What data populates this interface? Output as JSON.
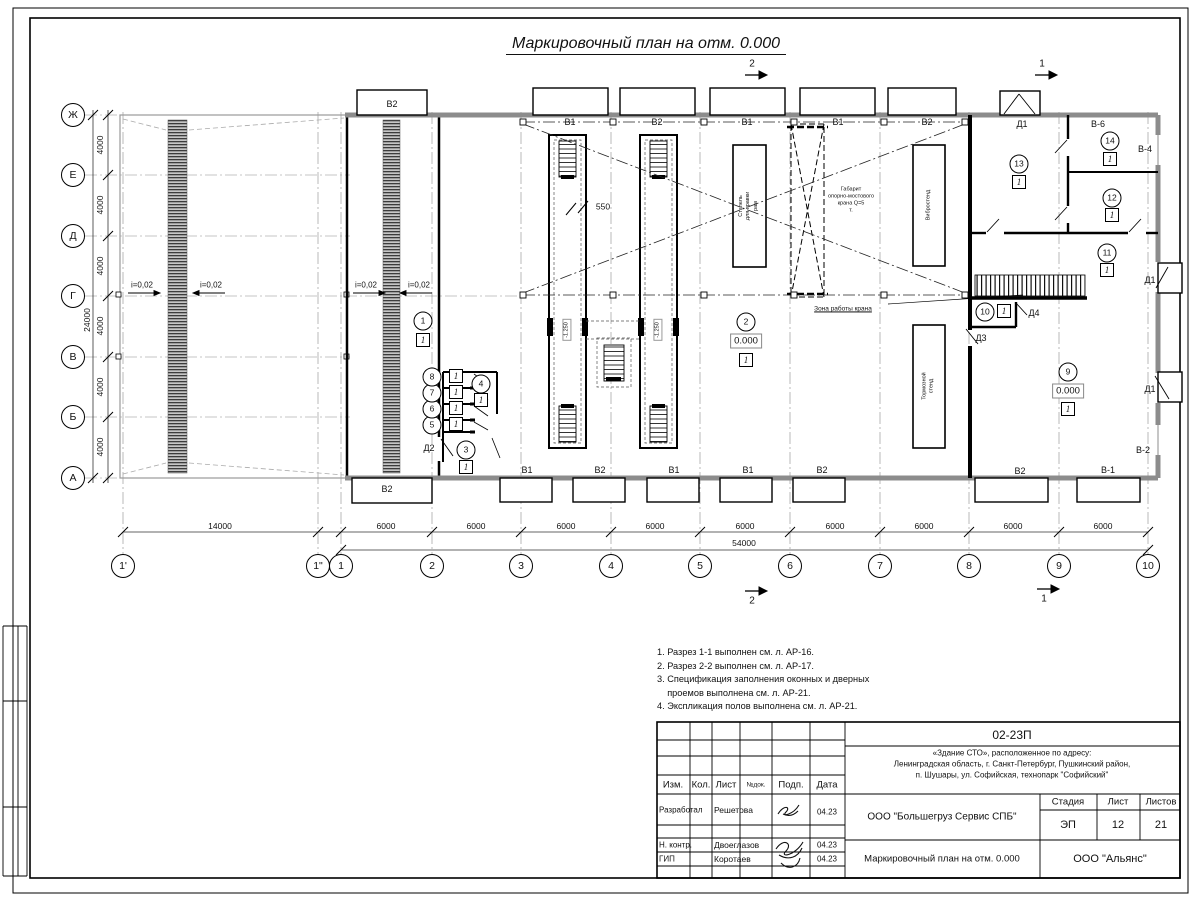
{
  "sheet_title": "Маркировочный план на отм. 0.000",
  "elevation": "0.000",
  "floor_mark": "1",
  "axes": {
    "rows": [
      {
        "l": "Ж",
        "y": 115
      },
      {
        "l": "Е",
        "y": 175
      },
      {
        "l": "Д",
        "y": 236
      },
      {
        "l": "Г",
        "y": 296
      },
      {
        "l": "В",
        "y": 357
      },
      {
        "l": "Б",
        "y": 417
      },
      {
        "l": "А",
        "y": 478
      }
    ],
    "cols": [
      {
        "l": "1'",
        "x": 123
      },
      {
        "l": "1\"",
        "x": 318
      },
      {
        "l": "1",
        "x": 341
      },
      {
        "l": "2",
        "x": 432
      },
      {
        "l": "3",
        "x": 521
      },
      {
        "l": "4",
        "x": 611
      },
      {
        "l": "5",
        "x": 700
      },
      {
        "l": "6",
        "x": 790
      },
      {
        "l": "7",
        "x": 880
      },
      {
        "l": "8",
        "x": 969
      },
      {
        "l": "9",
        "x": 1059
      },
      {
        "l": "10",
        "x": 1148
      }
    ],
    "row_dims": [
      {
        "t": "4000",
        "y": 145
      },
      {
        "t": "4000",
        "y": 205
      },
      {
        "t": "4000",
        "y": 266
      },
      {
        "t": "4000",
        "y": 326
      },
      {
        "t": "4000",
        "y": 387
      },
      {
        "t": "4000",
        "y": 447
      }
    ],
    "row_total": {
      "t": "24000",
      "y": 320
    },
    "col_dims": [
      {
        "t": "14000",
        "x": 220
      },
      {
        "t": "6000",
        "x": 386
      },
      {
        "t": "6000",
        "x": 476
      },
      {
        "t": "6000",
        "x": 566
      },
      {
        "t": "6000",
        "x": 655
      },
      {
        "t": "6000",
        "x": 745
      },
      {
        "t": "6000",
        "x": 835
      },
      {
        "t": "6000",
        "x": 924
      },
      {
        "t": "6000",
        "x": 1013
      },
      {
        "t": "6000",
        "x": 1103
      }
    ],
    "col_total": {
      "t": "54000",
      "x": 744
    }
  },
  "plan_labels": [
    {
      "t": "В2",
      "x": 392,
      "y": 105,
      "c": "win"
    },
    {
      "t": "В1",
      "x": 570,
      "y": 123,
      "c": "win"
    },
    {
      "t": "В2",
      "x": 657,
      "y": 123,
      "c": "win"
    },
    {
      "t": "В1",
      "x": 747,
      "y": 123,
      "c": "win"
    },
    {
      "t": "В1",
      "x": 838,
      "y": 123,
      "c": "win"
    },
    {
      "t": "В2",
      "x": 927,
      "y": 123,
      "c": "win"
    },
    {
      "t": "Д1",
      "x": 1022,
      "y": 125,
      "c": "door"
    },
    {
      "t": "В-6",
      "x": 1098,
      "y": 125,
      "c": "win"
    },
    {
      "t": "В-4",
      "x": 1145,
      "y": 150,
      "c": "win"
    },
    {
      "t": "Д1",
      "x": 1150,
      "y": 281,
      "c": "door"
    },
    {
      "t": "Д1",
      "x": 1150,
      "y": 390,
      "c": "door"
    },
    {
      "t": "В-2",
      "x": 1143,
      "y": 451,
      "c": "win"
    },
    {
      "t": "В2",
      "x": 387,
      "y": 490,
      "c": "win"
    },
    {
      "t": "В1",
      "x": 527,
      "y": 471,
      "c": "win"
    },
    {
      "t": "В2",
      "x": 600,
      "y": 471,
      "c": "win"
    },
    {
      "t": "В1",
      "x": 674,
      "y": 471,
      "c": "win"
    },
    {
      "t": "В1",
      "x": 748,
      "y": 471,
      "c": "win"
    },
    {
      "t": "В2",
      "x": 822,
      "y": 471,
      "c": "win"
    },
    {
      "t": "В2",
      "x": 1020,
      "y": 472,
      "c": "win"
    },
    {
      "t": "В-1",
      "x": 1108,
      "y": 471,
      "c": "win"
    },
    {
      "t": "Д2",
      "x": 429,
      "y": 449,
      "c": "door"
    },
    {
      "t": "Д3",
      "x": 981,
      "y": 339,
      "c": "door"
    },
    {
      "t": "Д4",
      "x": 1034,
      "y": 314,
      "c": "door"
    },
    {
      "t": "i=0,02",
      "x": 142,
      "y": 286,
      "c": "slope"
    },
    {
      "t": "i=0,02",
      "x": 211,
      "y": 286,
      "c": "slope"
    },
    {
      "t": "i=0,02",
      "x": 366,
      "y": 286,
      "c": "slope"
    },
    {
      "t": "i=0,02",
      "x": 419,
      "y": 286,
      "c": "slope"
    },
    {
      "t": "550",
      "x": 603,
      "y": 207,
      "c": "dim"
    },
    {
      "t": "Зона работы крана",
      "x": 843,
      "y": 309,
      "c": "zone"
    },
    {
      "t": "Габарит\nопорно-мостового\nкрана Q=5\nт.",
      "x": 851,
      "y": 201,
      "c": "tiny"
    },
    {
      "t": "-1.250",
      "x": 567,
      "y": 330,
      "c": "pitlev"
    },
    {
      "t": "-1.250",
      "x": 658,
      "y": 330,
      "c": "pitlev"
    },
    {
      "t": "Стапель\nдля правки\nрам",
      "x": 749,
      "y": 206,
      "c": "equip"
    },
    {
      "t": "Вибростенд",
      "x": 929,
      "y": 205,
      "c": "equip"
    },
    {
      "t": "Тормозной\nстенд",
      "x": 929,
      "y": 386,
      "c": "equip"
    },
    {
      "t": "2",
      "x": 752,
      "y": 64,
      "c": "sec"
    },
    {
      "t": "1",
      "x": 1042,
      "y": 64,
      "c": "sec"
    },
    {
      "t": "2",
      "x": 752,
      "y": 601,
      "c": "sec"
    },
    {
      "t": "1",
      "x": 1044,
      "y": 599,
      "c": "sec"
    }
  ],
  "room_markers": [
    {
      "n": "1",
      "x": 423,
      "y": 321,
      "f": [
        423,
        340
      ]
    },
    {
      "n": "2",
      "x": 746,
      "y": 322,
      "e": [
        746,
        341
      ],
      "f": [
        746,
        360
      ]
    },
    {
      "n": "3",
      "x": 466,
      "y": 450,
      "f": [
        466,
        467
      ]
    },
    {
      "n": "4",
      "x": 481,
      "y": 384,
      "f": [
        481,
        400
      ]
    },
    {
      "n": "5",
      "x": 432,
      "y": 425,
      "f": [
        456,
        424
      ]
    },
    {
      "n": "6",
      "x": 432,
      "y": 409,
      "f": [
        456,
        408
      ]
    },
    {
      "n": "7",
      "x": 432,
      "y": 393,
      "f": [
        456,
        392
      ]
    },
    {
      "n": "8",
      "x": 432,
      "y": 377,
      "f": [
        456,
        376
      ]
    },
    {
      "n": "9",
      "x": 1068,
      "y": 372,
      "e": [
        1068,
        391
      ],
      "f": [
        1068,
        409
      ]
    },
    {
      "n": "10",
      "x": 985,
      "y": 312,
      "f": [
        1004,
        311
      ]
    },
    {
      "n": "11",
      "x": 1107,
      "y": 253,
      "f": [
        1107,
        270
      ]
    },
    {
      "n": "12",
      "x": 1112,
      "y": 198,
      "f": [
        1112,
        215
      ]
    },
    {
      "n": "13",
      "x": 1019,
      "y": 164,
      "f": [
        1019,
        182
      ]
    },
    {
      "n": "14",
      "x": 1110,
      "y": 141,
      "f": [
        1110,
        159
      ]
    }
  ],
  "notes": [
    "1. Разрез 1-1 выполнен см. л. АР-16.",
    "2. Разрез 2-2 выполнен см. л. АР-17.",
    "3. Спецификация заполнения оконных и дверных",
    "    проемов выполнена см. л. АР-21.",
    "4. Экспликация полов выполнена см. л. АР-21."
  ],
  "title_block": {
    "doc_number": "02-23П",
    "address_lines": [
      "«Здание СТО», расположенное по адресу:",
      "Ленинградская область, г. Санкт-Петербург, Пушкинский район,",
      "п. Шушары, ул. Софийская, технопарк \"Софийский\""
    ],
    "header_cols": [
      "Изм.",
      "Кол.",
      "Лист",
      "№док.",
      "Подп.",
      "Дата"
    ],
    "crew": [
      {
        "role": "Разработал",
        "name": "Решетова",
        "date": "04.23"
      },
      {
        "role": "Н. контр.",
        "name": "Двоеглазов",
        "date": "04.23"
      },
      {
        "role": "ГИП",
        "name": "Коротаев",
        "date": "04.23"
      }
    ],
    "company": "ООО \"Большегруз Сервис СПБ\"",
    "drawing_title": "Маркировочный план на отм. 0.000",
    "org": "ООО \"Альянс\"",
    "stage_label": "Стадия",
    "sheet_label": "Лист",
    "sheets_label": "Листов",
    "stage": "ЭП",
    "sheet_no": "12",
    "sheets_total": "21"
  }
}
